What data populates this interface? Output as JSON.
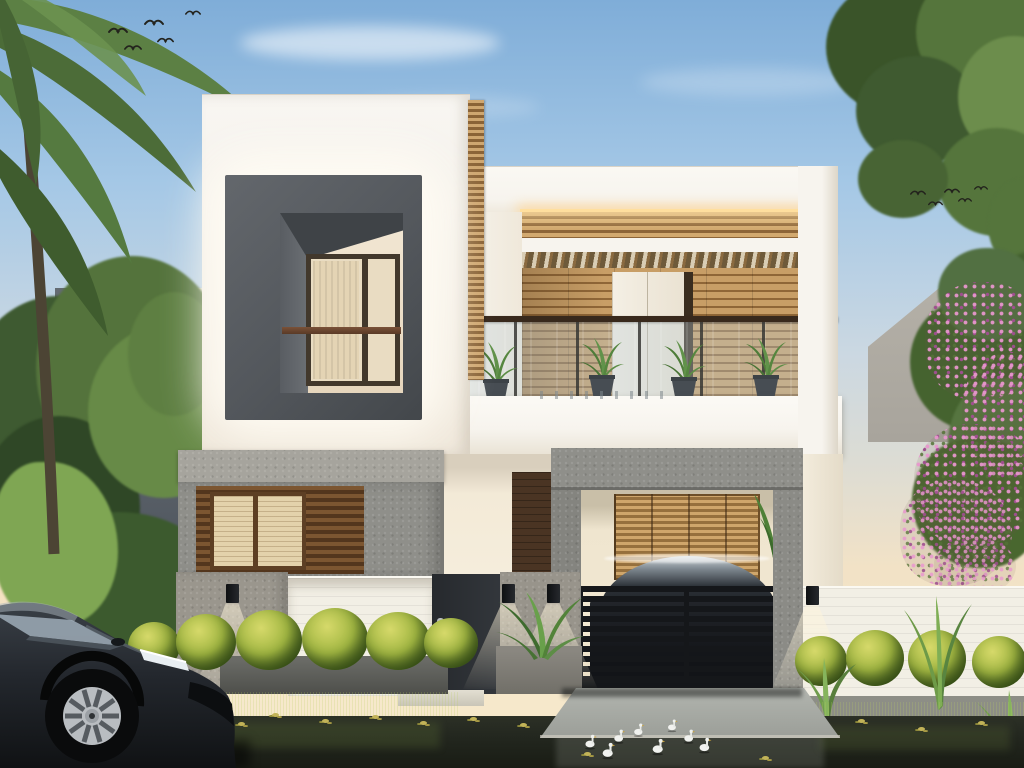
{
  "scene": {
    "title": "3D architectural rendering of a modern two-storey villa at dusk",
    "setting": "dusk, warm LED accent lighting, wet street with pond reflection in foreground",
    "colors": {
      "sky_top": "#7fadd8",
      "sky_mid": "#a5c8e6",
      "sky_soft": "#cbd8e2",
      "sky_horizon": "#f2e2c6",
      "wall_white": "#f7f4ee",
      "wall_warm": "#f3ead7",
      "wall_shade": "#e7dfcf",
      "concrete": "#8f8f8a",
      "concrete_light": "#a6a49d",
      "concrete_dark": "#74746f",
      "frame_gray": "#53575c",
      "frame_gray_dark": "#43474b",
      "wood_light": "#d2a96f",
      "wood_dark": "#8d6538",
      "wood_deep": "#5a3c20",
      "blind_cream": "#e3d2ab",
      "door_wood": "#4a3423",
      "gate_black": "#15171a",
      "led_warm": "#ffdf9e",
      "halo_white": "rgba(255,252,243,0.92)",
      "lamp_glow": "rgba(255,245,219,0.55)",
      "fence_white": "#f2efe5",
      "bush_light": "#d6d96a",
      "bush_mid": "#a3b843",
      "bush_dark": "#5d7a28",
      "foliage_dark": "#3a5429",
      "foliage_mid": "#55753c",
      "foliage_light": "#7da455",
      "pink_flower": "#c472b2",
      "pink_deep": "#9e4f8e",
      "water": "#23271f",
      "grass": "#46582e",
      "driveway": "#b2b5af",
      "car_dark": "#22262b",
      "duck_white": "#f1f2ef",
      "bg_build_left": "#5a6169",
      "bg_build_right": "#a8a49c",
      "trunk": "#4c4434"
    },
    "counts": {
      "birds": 10,
      "ducks": 8,
      "balcony_plants": 4,
      "hedge_bushes": 10,
      "wall_lamps": 4
    },
    "birds": [
      {
        "x": 108,
        "y": 22,
        "s": 1.0
      },
      {
        "x": 124,
        "y": 40,
        "s": 0.9
      },
      {
        "x": 144,
        "y": 14,
        "s": 1.0
      },
      {
        "x": 157,
        "y": 33,
        "s": 0.85
      },
      {
        "x": 185,
        "y": 6,
        "s": 0.8
      },
      {
        "x": 910,
        "y": 186,
        "s": 0.8
      },
      {
        "x": 928,
        "y": 197,
        "s": 0.75
      },
      {
        "x": 944,
        "y": 184,
        "s": 0.8
      },
      {
        "x": 958,
        "y": 194,
        "s": 0.7
      },
      {
        "x": 974,
        "y": 182,
        "s": 0.7
      }
    ],
    "balcony_plants": [
      {
        "x": 474,
        "y": 340
      },
      {
        "x": 580,
        "y": 336
      },
      {
        "x": 662,
        "y": 338
      },
      {
        "x": 744,
        "y": 336
      }
    ],
    "wall_lamps": [
      {
        "x": 187,
        "y": 584,
        "h": 108
      },
      {
        "x": 463,
        "y": 584,
        "h": 86
      },
      {
        "x": 508,
        "y": 584,
        "h": 86
      },
      {
        "x": 767,
        "y": 586,
        "h": 96
      }
    ],
    "hedge_bushes": [
      {
        "x": 128,
        "y": 622,
        "w": 52,
        "h": 48
      },
      {
        "x": 176,
        "y": 614,
        "w": 60,
        "h": 56
      },
      {
        "x": 236,
        "y": 610,
        "w": 66,
        "h": 60
      },
      {
        "x": 302,
        "y": 608,
        "w": 66,
        "h": 62
      },
      {
        "x": 366,
        "y": 612,
        "w": 64,
        "h": 58
      },
      {
        "x": 424,
        "y": 618,
        "w": 54,
        "h": 50
      },
      {
        "x": 795,
        "y": 636,
        "w": 52,
        "h": 50
      },
      {
        "x": 846,
        "y": 630,
        "w": 58,
        "h": 56
      },
      {
        "x": 908,
        "y": 630,
        "w": 58,
        "h": 58
      },
      {
        "x": 972,
        "y": 636,
        "w": 54,
        "h": 52
      }
    ],
    "ducks": [
      {
        "x": 583,
        "y": 733,
        "s": 1.0
      },
      {
        "x": 600,
        "y": 741,
        "s": 1.1
      },
      {
        "x": 612,
        "y": 728,
        "s": 0.95
      },
      {
        "x": 632,
        "y": 722,
        "s": 0.9
      },
      {
        "x": 650,
        "y": 737,
        "s": 1.1
      },
      {
        "x": 666,
        "y": 718,
        "s": 0.85
      },
      {
        "x": 682,
        "y": 728,
        "s": 0.95
      },
      {
        "x": 697,
        "y": 736,
        "s": 1.05
      }
    ],
    "water_leaves": [
      {
        "x": 200,
        "y": 716
      },
      {
        "x": 238,
        "y": 722
      },
      {
        "x": 272,
        "y": 713
      },
      {
        "x": 322,
        "y": 719
      },
      {
        "x": 372,
        "y": 715
      },
      {
        "x": 420,
        "y": 721
      },
      {
        "x": 470,
        "y": 717
      },
      {
        "x": 520,
        "y": 723
      },
      {
        "x": 700,
        "y": 721
      },
      {
        "x": 745,
        "y": 715
      },
      {
        "x": 800,
        "y": 725
      },
      {
        "x": 858,
        "y": 719
      },
      {
        "x": 918,
        "y": 727
      },
      {
        "x": 978,
        "y": 721
      },
      {
        "x": 584,
        "y": 752
      },
      {
        "x": 762,
        "y": 756
      }
    ]
  }
}
